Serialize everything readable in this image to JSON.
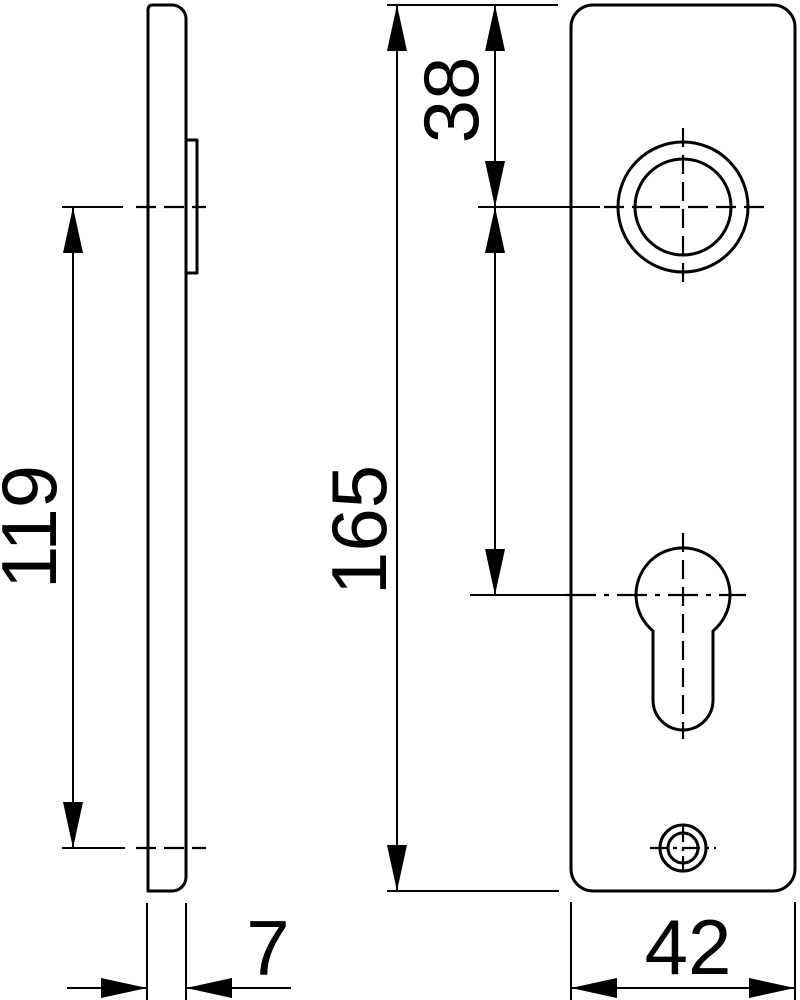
{
  "page": {
    "background": "#ffffff",
    "ink": "#000000"
  },
  "drawing": {
    "kind": "technical-drawing",
    "dimensions": {
      "centers_distance": "119",
      "plate_height": "165",
      "top_to_handle_center": "38",
      "plate_width": "42",
      "plate_thickness": "7"
    }
  }
}
